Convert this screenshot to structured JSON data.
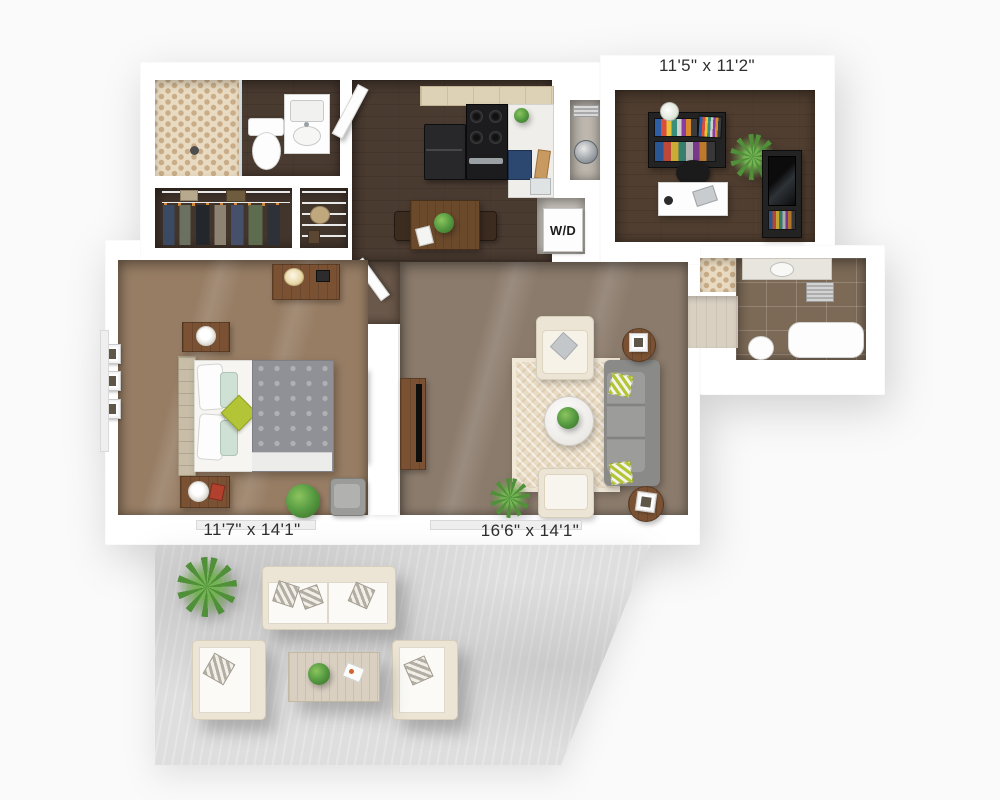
{
  "floorplan": {
    "labels": {
      "office_dims": "11'5\" x 11'2\"",
      "bedroom_dims": "11'7\" x 14'1\"",
      "living_dims": "16'6\" x 14'1\"",
      "washer_dryer": "W/D"
    },
    "palette": {
      "background": "#fafafa",
      "wall": "#ffffff",
      "label_ink": "#2e2e2e",
      "floor_dark": "#4a3b31",
      "floor_office": "#503e30",
      "floor_living": "#8b7b6c",
      "floor_bedroom": "#977d64",
      "floor_hall": "#6a584a",
      "closet_floor": "#42352c",
      "tile_brown": "#7c6a57",
      "tile_beige": "#d9d0c2",
      "hex_base": "#e9dbc2",
      "hex_dot": "#c9ad88",
      "rug_base": "#e9dcc5",
      "rug_border": "#f1e8d8",
      "sofa": "#9c9c9a",
      "sofa_dark": "#8a8a88",
      "cream": "#ece5d5",
      "accent_green": "#b4c437",
      "wood": "#7a5233",
      "dining_wood": "#6b4a2c",
      "cabinet": "#ded2b6",
      "appliance": "#28282a",
      "counter": "#efeeea",
      "blue_cabinet": "#2c4770",
      "patio": "#dedede",
      "plant": "#5a9e44",
      "headboard": "#c8bda6",
      "bed_duvet": "#8f9196"
    }
  }
}
